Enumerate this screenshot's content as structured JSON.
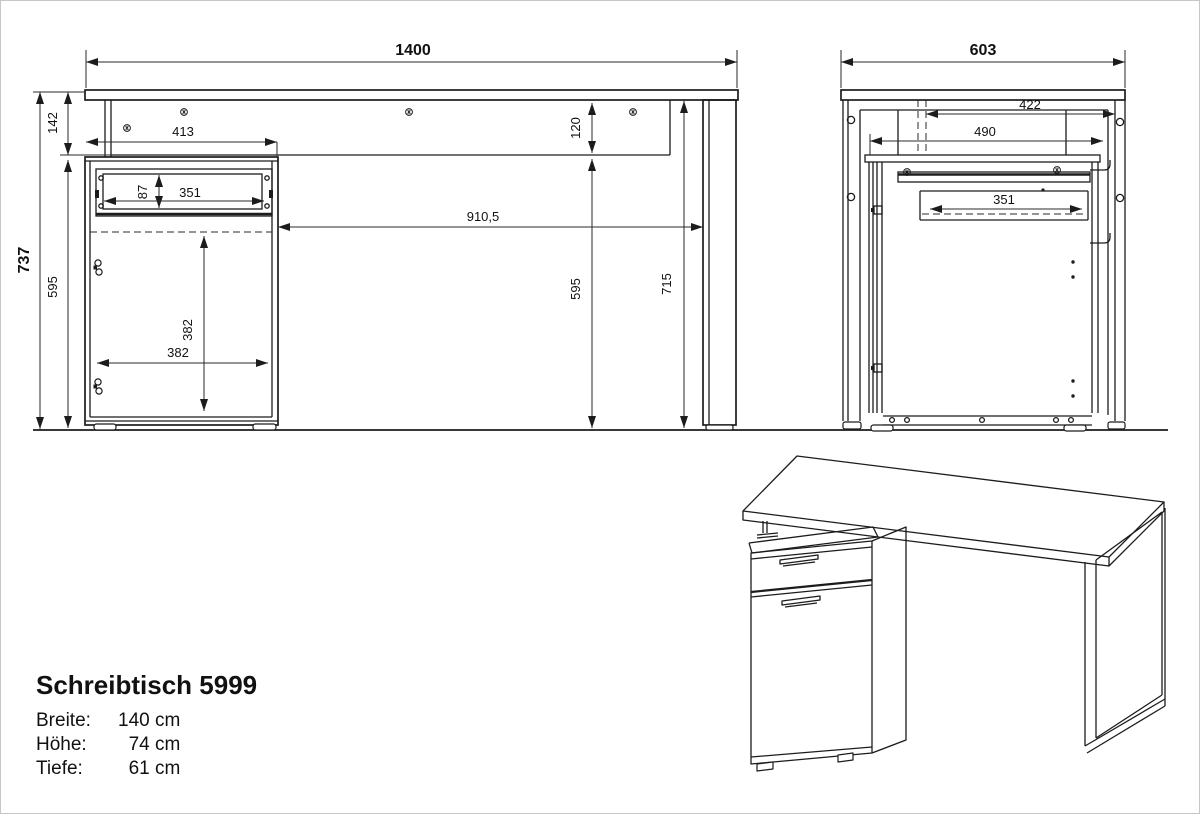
{
  "product": {
    "title": "Schreibtisch 5999",
    "specs": [
      {
        "label": "Breite:",
        "value": "140 cm"
      },
      {
        "label": "Höhe:",
        "value": "74 cm"
      },
      {
        "label": "Tiefe:",
        "value": "61 cm"
      }
    ]
  },
  "front_view": {
    "dims": {
      "total_width": "1400",
      "top_section_height": "142",
      "total_height": "737",
      "cabinet_height_left": "595",
      "top_inset": "413",
      "drawer_height": "87",
      "drawer_width": "351",
      "knee_space": "910,5",
      "apron_height": "120",
      "cabinet_height_right": "595",
      "leg_height": "715",
      "door_inner_height": "382",
      "door_inner_width": "382"
    }
  },
  "side_view": {
    "dims": {
      "total_depth": "603",
      "rear_inset": "422",
      "top_depth": "490",
      "drawer_depth": "351"
    }
  }
}
